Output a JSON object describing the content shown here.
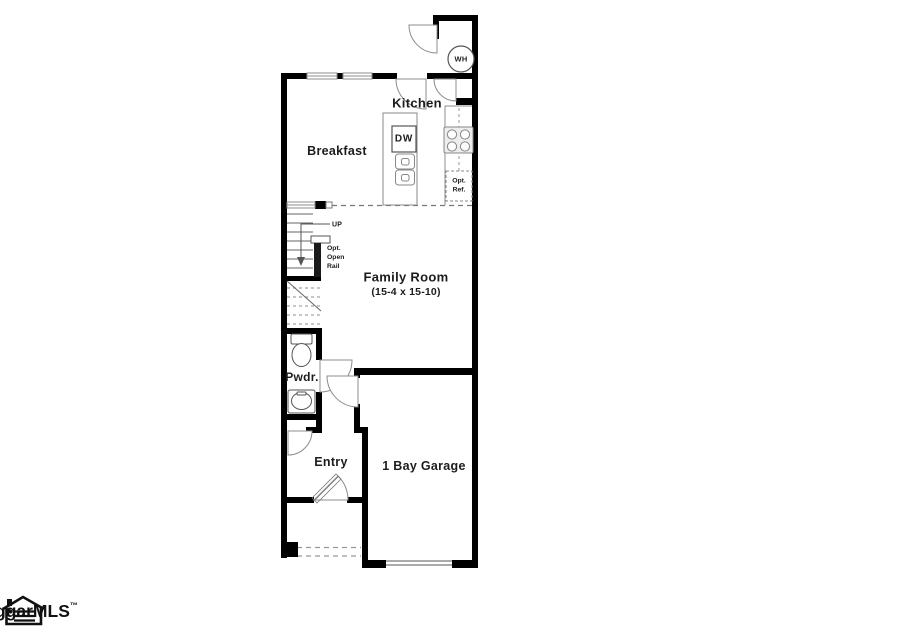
{
  "floor_plan": {
    "rooms": {
      "kitchen": {
        "label": "Kitchen"
      },
      "breakfast": {
        "label": "Breakfast"
      },
      "family_room": {
        "label": "Family Room",
        "dimensions": "(15-4 x 15-10)"
      },
      "powder_room": {
        "label": "Pwdr."
      },
      "entry": {
        "label": "Entry"
      },
      "garage": {
        "label": "1 Bay Garage"
      }
    },
    "annotations": {
      "stairs_direction": "UP",
      "optional_open_rail": "Opt.\nOpen\nRail",
      "optional_refrigerator": "Opt.\nRef.",
      "dishwasher": "DW",
      "water_heater": "WH"
    },
    "colors": {
      "walls": "#000000",
      "fixture_lines": "#8c8c8c",
      "text": "#1c1c1c",
      "background": "#ffffff"
    }
  },
  "footer": {
    "mls_logo_text": "ggarMLS",
    "trademark": "™"
  }
}
